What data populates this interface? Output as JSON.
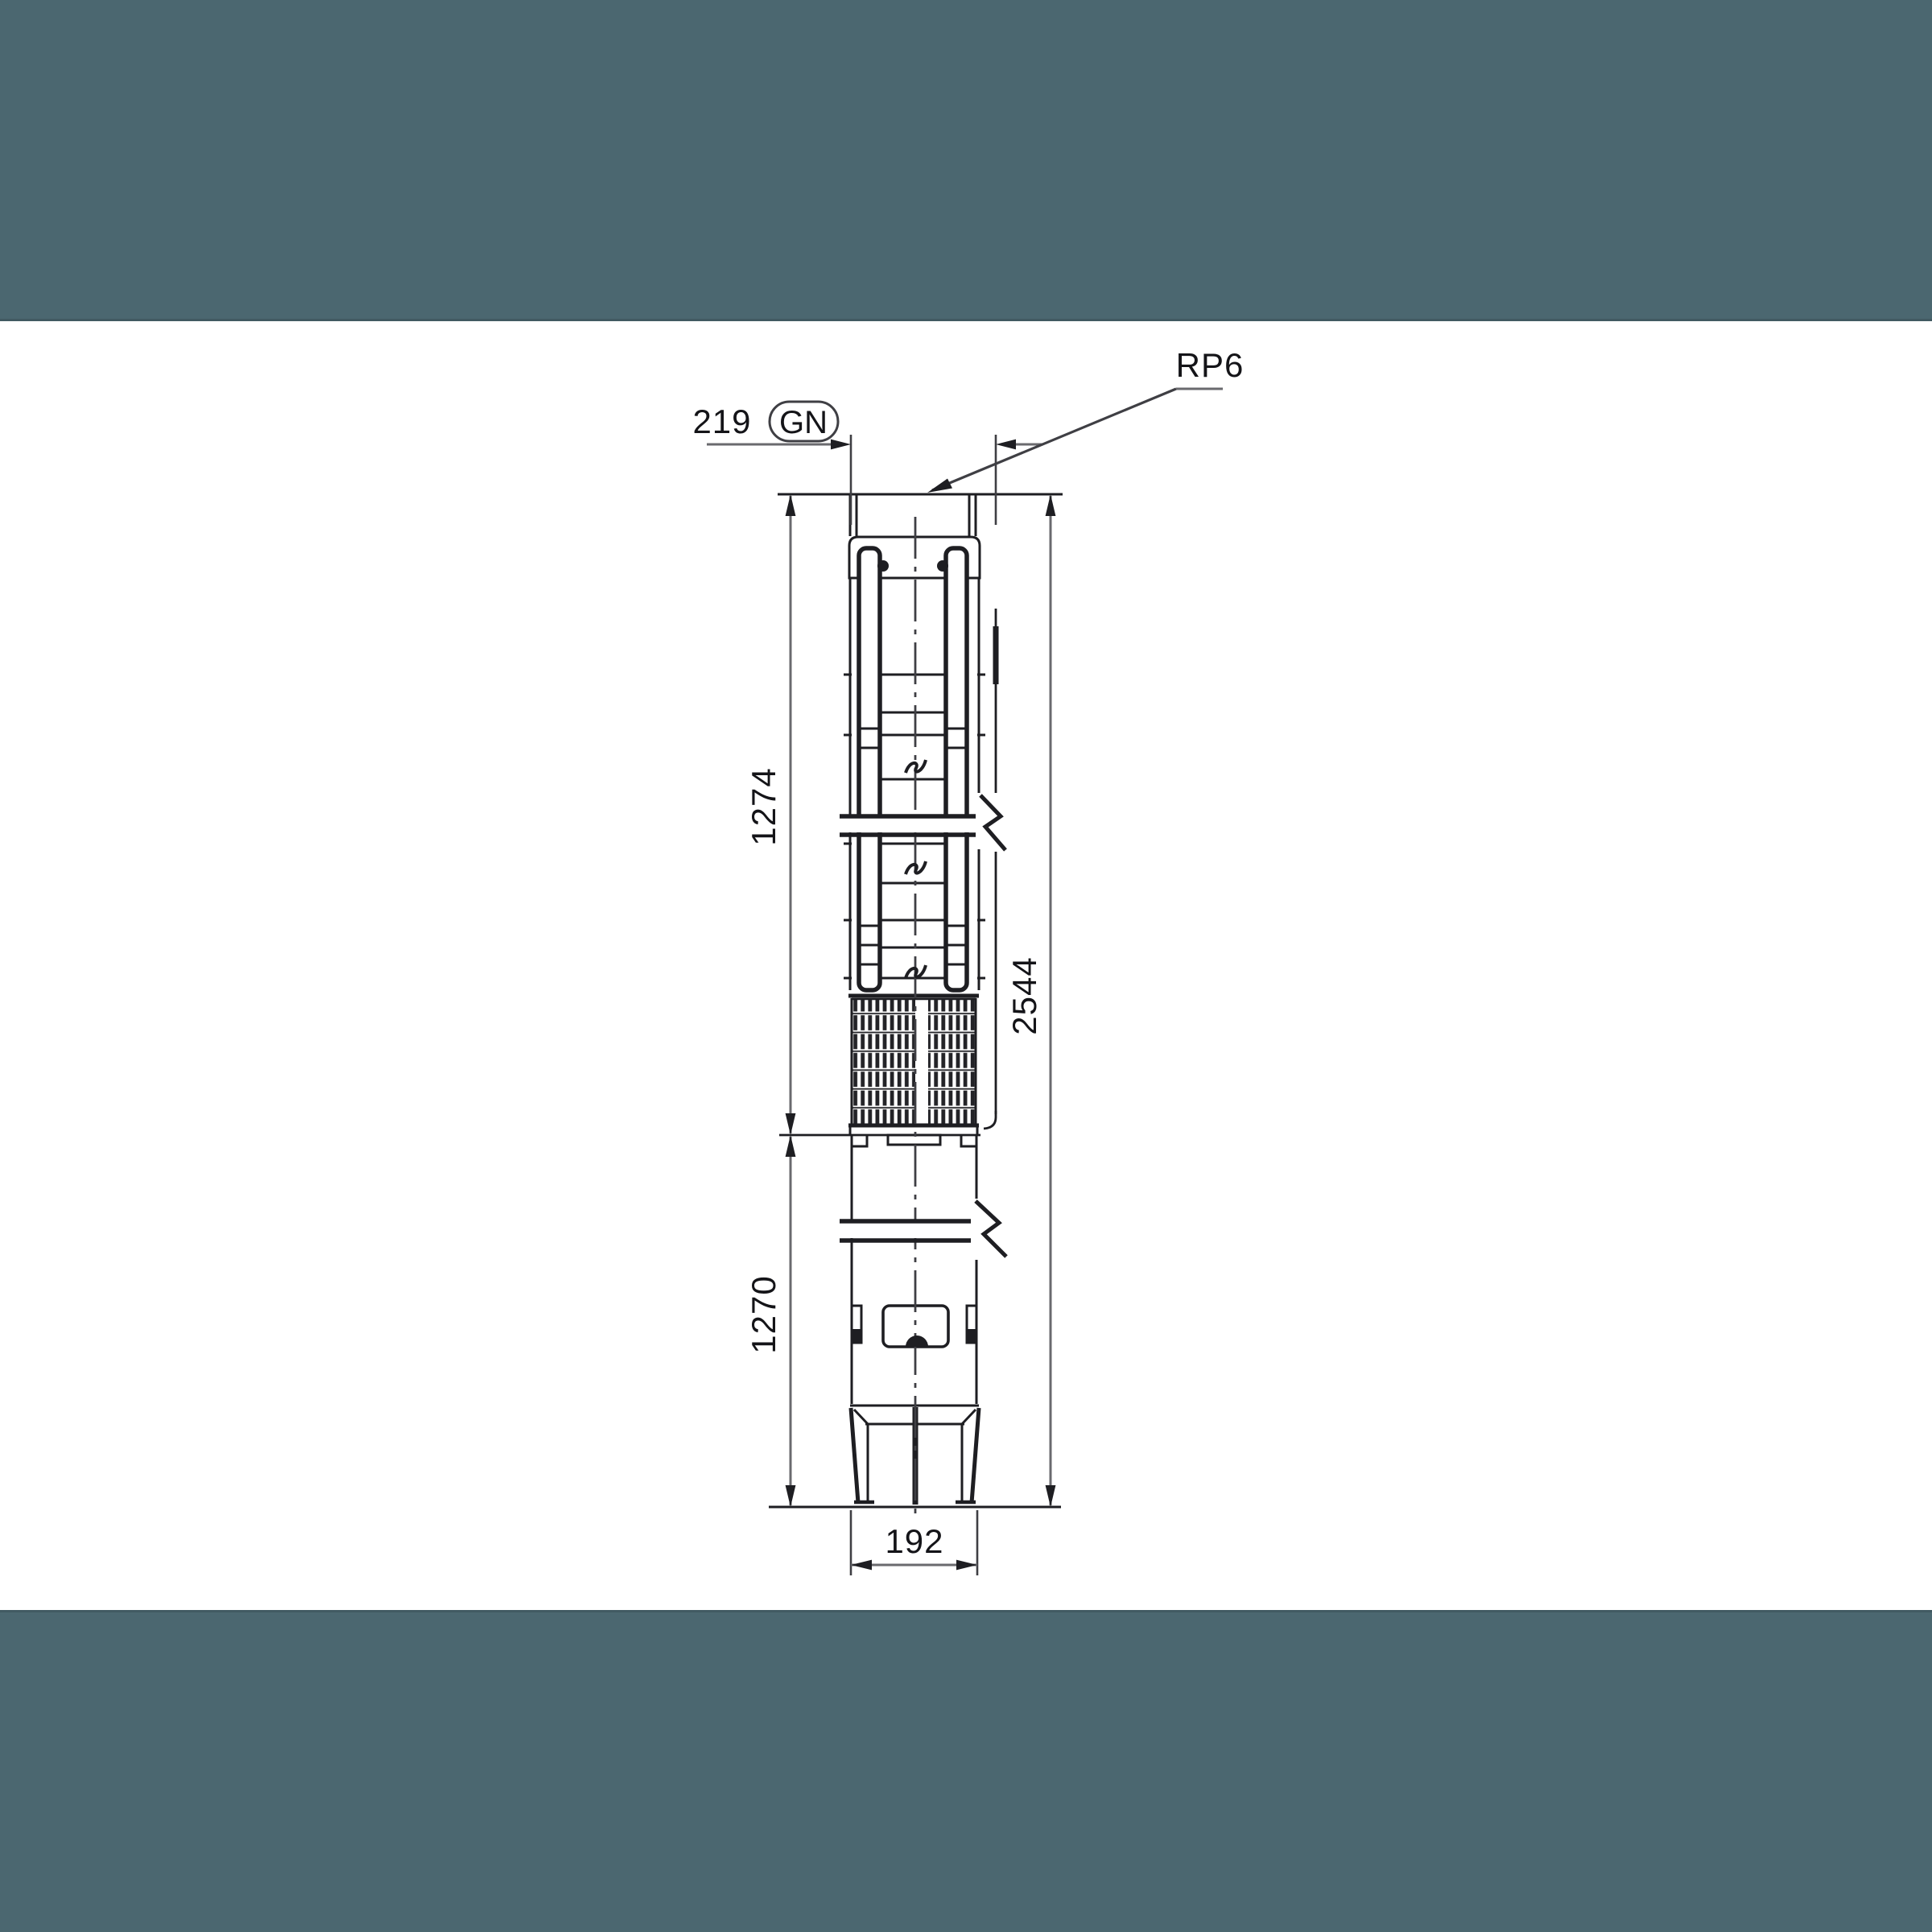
{
  "css_vars": {
    "--paper-color": "#ffffff",
    "--band-color": "#4b6770",
    "--band-edge-color": "rgba(0,0,0,0.12)",
    "--line-color": "#1e1e22",
    "--dim-color": "#6a6a6e",
    "--ext-color": "#3f3f44",
    "--text-color": "#141418"
  },
  "drawing": {
    "labels": {
      "connection_thread": "RP6",
      "outer_diameter_top": "219",
      "badge": "GN",
      "pump_section_length": "1274",
      "motor_section_length": "1270",
      "total_length": "2544",
      "bottom_diameter": "192"
    }
  }
}
